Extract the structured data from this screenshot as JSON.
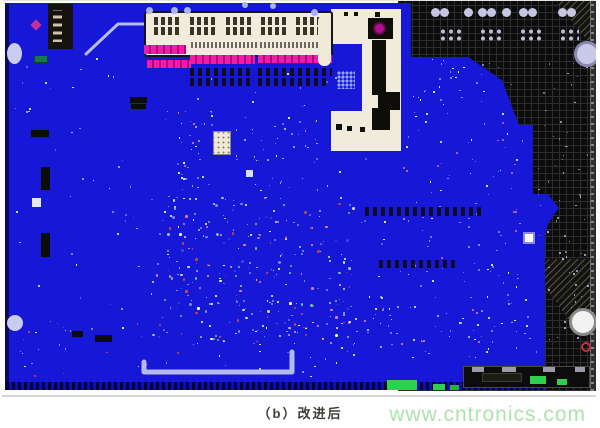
{
  "caption": {
    "text": "（b）改进后"
  },
  "watermark": {
    "text": "www.cntronics.com"
  },
  "board": {
    "palette": {
      "board_blue": "#1717d8",
      "magenta": "#e312a0",
      "grid_black": "#0c0c0c",
      "grid_line": "#2d2d2d",
      "cream": "#f0ebdb",
      "lavender": "#c9cdf0",
      "green": "#2fcf4f",
      "trace": "#b4baea",
      "watermark_green": "#aee2ae",
      "caption_text": "#3e3e36",
      "red": "#c23040"
    },
    "connector": {
      "x": 142,
      "y": 10,
      "w": 189,
      "h": 46,
      "row1_y": 4,
      "row2_y": 14,
      "pad_group_xs": [
        8,
        44,
        80,
        115,
        150
      ],
      "pad_group_w": 27,
      "pad_group_h": 8,
      "strips": [
        {
          "x": 45,
          "y": 29,
          "w": 66,
          "h": 6
        },
        {
          "x": 114,
          "y": 29,
          "w": 66,
          "h": 6
        }
      ]
    },
    "traces": {
      "paths": [
        {
          "name": "trace-top-left",
          "width": 3,
          "points": [
            [
              84,
              53
            ],
            [
              116,
              23
            ],
            [
              143,
              23
            ]
          ]
        },
        {
          "name": "trace-bottom-u",
          "width": 5,
          "points": [
            [
              142,
              361
            ],
            [
              142,
              371
            ],
            [
              290,
              371
            ],
            [
              290,
              351
            ]
          ]
        }
      ]
    },
    "components": [
      {
        "name": "ic-top-left",
        "type": "ic",
        "x": 46,
        "y": 3,
        "w": 25,
        "h": 45
      },
      {
        "name": "magenta-diamond",
        "type": "rect",
        "x": 30,
        "y": 20,
        "w": 8,
        "h": 8,
        "color": "#c23099",
        "rot": 45
      },
      {
        "name": "green-chip-left",
        "type": "rect",
        "x": 32,
        "y": 54,
        "w": 14,
        "h": 8,
        "color": "#157a46",
        "border": "1px solid #0a4428"
      },
      {
        "name": "mounting-hole-left-top",
        "type": "circle",
        "x": 5,
        "y": 42,
        "w": 15,
        "h": 21,
        "color": "#c9cdf0"
      },
      {
        "name": "mounting-hole-left-bottom",
        "type": "circle",
        "x": 5,
        "y": 314,
        "w": 16,
        "h": 16,
        "color": "#c9cdf0"
      },
      {
        "name": "bar-dark-1",
        "type": "rect",
        "x": 128,
        "y": 96,
        "w": 17,
        "h": 6,
        "color": "#0d0d08"
      },
      {
        "name": "bar-dark-2",
        "type": "rect",
        "x": 129,
        "y": 103,
        "w": 15,
        "h": 5,
        "color": "#0d0d08"
      },
      {
        "name": "bar-dark-3",
        "type": "rect",
        "x": 29,
        "y": 129,
        "w": 18,
        "h": 7,
        "color": "#0d0d08"
      },
      {
        "name": "bar-dark-4",
        "type": "rect",
        "x": 39,
        "y": 166,
        "w": 9,
        "h": 23,
        "color": "#0d0d08"
      },
      {
        "name": "bar-dark-5",
        "type": "rect",
        "x": 39,
        "y": 232,
        "w": 9,
        "h": 24,
        "color": "#0d0d08"
      },
      {
        "name": "bar-dark-6",
        "type": "rect",
        "x": 93,
        "y": 334,
        "w": 17,
        "h": 7,
        "color": "#0d0d08"
      },
      {
        "name": "bar-dark-7",
        "type": "rect",
        "x": 70,
        "y": 330,
        "w": 11,
        "h": 6,
        "color": "#0d0d08"
      },
      {
        "name": "pad-white-1",
        "type": "rect",
        "x": 30,
        "y": 197,
        "w": 9,
        "h": 9,
        "color": "#e4e8fa"
      },
      {
        "name": "pad-white-2",
        "type": "rect",
        "x": 244,
        "y": 169,
        "w": 7,
        "h": 7,
        "color": "#d8defa"
      },
      {
        "name": "chip-center",
        "type": "chip",
        "x": 211,
        "y": 130,
        "w": 18,
        "h": 24
      },
      {
        "name": "pad-white-ringed",
        "type": "rect",
        "x": 521,
        "y": 231,
        "w": 12,
        "h": 12,
        "color": "#ffffff",
        "border": "2px solid #8a8af0"
      },
      {
        "name": "circle-top-right",
        "type": "circle",
        "x": 572,
        "y": 40,
        "w": 26,
        "h": 26,
        "color": "#c9c9e8",
        "border": "3px solid #8a8ab0"
      },
      {
        "name": "circle-bottom-right",
        "type": "circle",
        "x": 567,
        "y": 307,
        "w": 28,
        "h": 28,
        "color": "#f2f2f2",
        "border": "3px solid #8a8a8a"
      },
      {
        "name": "ring-red",
        "type": "circle",
        "x": 579,
        "y": 341,
        "w": 10,
        "h": 10,
        "color": "rgba(0,0,0,0)",
        "border": "2px solid #c23040"
      },
      {
        "name": "via-1",
        "type": "circle",
        "x": 144,
        "y": 6,
        "w": 7,
        "h": 7,
        "color": "#a9b3f2"
      },
      {
        "name": "via-2",
        "type": "circle",
        "x": 169,
        "y": 6,
        "w": 7,
        "h": 7,
        "color": "#a9b3f2"
      },
      {
        "name": "via-3",
        "type": "circle",
        "x": 182,
        "y": 6,
        "w": 7,
        "h": 7,
        "color": "#a9b3f2"
      },
      {
        "name": "via-4",
        "type": "circle",
        "x": 309,
        "y": 8,
        "w": 7,
        "h": 7,
        "color": "#a9b3f2"
      },
      {
        "name": "via-5",
        "type": "circle",
        "x": 240,
        "y": 1,
        "w": 6,
        "h": 6,
        "color": "#a9b3f2"
      },
      {
        "name": "via-6",
        "type": "circle",
        "x": 268,
        "y": 2,
        "w": 6,
        "h": 6,
        "color": "#a9b3f2"
      },
      {
        "name": "grid-pad-1",
        "type": "circle",
        "x": 429,
        "y": 7,
        "w": 9,
        "h": 9,
        "color": "#c6c6e2"
      },
      {
        "name": "grid-pad-2",
        "type": "circle",
        "x": 438,
        "y": 7,
        "w": 9,
        "h": 9,
        "color": "#c6c6e2"
      },
      {
        "name": "grid-pad-3",
        "type": "circle",
        "x": 462,
        "y": 7,
        "w": 9,
        "h": 9,
        "color": "#c6c6e2"
      },
      {
        "name": "grid-pad-4",
        "type": "circle",
        "x": 476,
        "y": 7,
        "w": 9,
        "h": 9,
        "color": "#c6c6e2"
      },
      {
        "name": "grid-pad-5",
        "type": "circle",
        "x": 485,
        "y": 7,
        "w": 9,
        "h": 9,
        "color": "#c6c6e2"
      },
      {
        "name": "grid-pad-6",
        "type": "circle",
        "x": 500,
        "y": 7,
        "w": 9,
        "h": 9,
        "color": "#c6c6e2"
      },
      {
        "name": "grid-pad-7",
        "type": "circle",
        "x": 517,
        "y": 7,
        "w": 9,
        "h": 9,
        "color": "#c6c6e2"
      },
      {
        "name": "grid-pad-8",
        "type": "circle",
        "x": 526,
        "y": 7,
        "w": 9,
        "h": 9,
        "color": "#c6c6e2"
      },
      {
        "name": "grid-pad-9",
        "type": "circle",
        "x": 556,
        "y": 7,
        "w": 9,
        "h": 9,
        "color": "#c6c6e2"
      },
      {
        "name": "grid-pad-10",
        "type": "circle",
        "x": 565,
        "y": 7,
        "w": 9,
        "h": 9,
        "color": "#c6c6e2"
      },
      {
        "name": "pad-grid-1",
        "type": "padgrid",
        "x": 437,
        "y": 27,
        "w": 23,
        "h": 14
      },
      {
        "name": "pad-grid-2",
        "type": "padgrid",
        "x": 477,
        "y": 27,
        "w": 23,
        "h": 14
      },
      {
        "name": "pad-grid-3",
        "type": "padgrid",
        "x": 517,
        "y": 27,
        "w": 23,
        "h": 14
      },
      {
        "name": "pad-grid-4",
        "type": "padgrid",
        "x": 557,
        "y": 27,
        "w": 20,
        "h": 14
      },
      {
        "name": "pink-pads-a",
        "type": "padrow-magenta",
        "x": 142,
        "y": 44,
        "w": 42,
        "h": 9
      },
      {
        "name": "pink-pads-b",
        "type": "padrow-magenta",
        "x": 145,
        "y": 59,
        "w": 44,
        "h": 8
      },
      {
        "name": "pink-pads-c",
        "type": "padrow-magenta",
        "x": 188,
        "y": 54,
        "w": 65,
        "h": 9
      },
      {
        "name": "pink-pads-d",
        "type": "padrow-magenta",
        "x": 256,
        "y": 54,
        "w": 74,
        "h": 8
      },
      {
        "name": "pad-row-1",
        "type": "padrow-dark",
        "x": 188,
        "y": 67,
        "w": 64,
        "h": 8
      },
      {
        "name": "pad-row-2",
        "type": "padrow-dark",
        "x": 188,
        "y": 77,
        "w": 64,
        "h": 8
      },
      {
        "name": "pad-row-3",
        "type": "padrow-dark",
        "x": 256,
        "y": 67,
        "w": 74,
        "h": 8
      },
      {
        "name": "pad-row-4",
        "type": "padrow-dark",
        "x": 256,
        "y": 77,
        "w": 68,
        "h": 8
      },
      {
        "name": "pad-row-mid",
        "type": "padrow-dark",
        "x": 363,
        "y": 206,
        "w": 118,
        "h": 9
      },
      {
        "name": "pad-row-mid-2",
        "type": "padrow-dark",
        "x": 377,
        "y": 259,
        "w": 78,
        "h": 8
      },
      {
        "name": "dot-matrix",
        "type": "dotgrid",
        "x": 335,
        "y": 70,
        "w": 18,
        "h": 18
      },
      {
        "name": "cutout-mini-board",
        "type": "rect",
        "x": 316,
        "y": 14,
        "w": 13,
        "h": 51,
        "color": "#efe9da",
        "radius": 6
      },
      {
        "name": "cutout-ic-1",
        "type": "rect",
        "x": 366,
        "y": 17,
        "w": 25,
        "h": 21,
        "color": "#0f0d0a"
      },
      {
        "name": "cutout-ic-2",
        "type": "rect",
        "x": 370,
        "y": 39,
        "w": 14,
        "h": 55,
        "color": "#0f0d0a"
      },
      {
        "name": "cutout-ic-3",
        "type": "rect",
        "x": 376,
        "y": 91,
        "w": 22,
        "h": 18,
        "color": "#0f0d0a"
      },
      {
        "name": "cutout-ic-4",
        "type": "rect",
        "x": 370,
        "y": 107,
        "w": 18,
        "h": 22,
        "color": "#0f0d0a"
      },
      {
        "name": "cutout-led-magenta",
        "type": "circle",
        "x": 371,
        "y": 21,
        "w": 13,
        "h": 13,
        "color": "#b01090",
        "border": "2px solid #5c0a48"
      },
      {
        "name": "cutout-dot-1",
        "type": "rect",
        "x": 334,
        "y": 123,
        "w": 6,
        "h": 6,
        "color": "#101010"
      },
      {
        "name": "cutout-dot-2",
        "type": "rect",
        "x": 345,
        "y": 125,
        "w": 5,
        "h": 5,
        "color": "#101010"
      },
      {
        "name": "cutout-dot-3",
        "type": "rect",
        "x": 358,
        "y": 126,
        "w": 5,
        "h": 5,
        "color": "#141414"
      },
      {
        "name": "cutout-dot-4",
        "type": "rect",
        "x": 342,
        "y": 11,
        "w": 4,
        "h": 4,
        "color": "#101010"
      },
      {
        "name": "cutout-dot-5",
        "type": "rect",
        "x": 352,
        "y": 11,
        "w": 4,
        "h": 4,
        "color": "#101010"
      },
      {
        "name": "cutout-dot-6",
        "type": "rect",
        "x": 373,
        "y": 11,
        "w": 5,
        "h": 5,
        "color": "#101010"
      },
      {
        "name": "bottom-connector-bar",
        "type": "rect",
        "x": 461,
        "y": 365,
        "w": 127,
        "h": 22,
        "color": "#0c0c0c",
        "border": "1px solid #4a4a42"
      },
      {
        "name": "bar-pad-1",
        "type": "rect",
        "x": 470,
        "y": 366,
        "w": 12,
        "h": 5,
        "color": "#9a9aa8"
      },
      {
        "name": "bar-pad-2",
        "type": "rect",
        "x": 500,
        "y": 366,
        "w": 14,
        "h": 5,
        "color": "#9a9aa8"
      },
      {
        "name": "bar-pad-3",
        "type": "rect",
        "x": 541,
        "y": 366,
        "w": 12,
        "h": 5,
        "color": "#9a9aa8"
      },
      {
        "name": "bar-pad-4",
        "type": "rect",
        "x": 573,
        "y": 366,
        "w": 10,
        "h": 5,
        "color": "#9a9aa8"
      },
      {
        "name": "bar-dark-inner",
        "type": "rect",
        "x": 480,
        "y": 372,
        "w": 40,
        "h": 9,
        "color": "#1c1c14",
        "border": "1px solid #3c3c30"
      },
      {
        "name": "bar-green-1",
        "type": "rect",
        "x": 528,
        "y": 375,
        "w": 16,
        "h": 8,
        "color": "#2fcf4f"
      },
      {
        "name": "bar-green-2",
        "type": "rect",
        "x": 555,
        "y": 378,
        "w": 10,
        "h": 6,
        "color": "#2fcf4f"
      },
      {
        "name": "green-pad-1",
        "type": "rect",
        "x": 385,
        "y": 379,
        "w": 30,
        "h": 10,
        "color": "#2fcf4f"
      },
      {
        "name": "green-pad-2",
        "type": "rect",
        "x": 431,
        "y": 383,
        "w": 12,
        "h": 6,
        "color": "#2fcf4f"
      },
      {
        "name": "green-pad-3",
        "type": "rect",
        "x": 448,
        "y": 384,
        "w": 9,
        "h": 5,
        "color": "#28b043"
      }
    ],
    "texture": {
      "seed": 7,
      "clusters": [
        {
          "name": "board-sparse",
          "area": [
            12,
            55,
            380,
            300
          ],
          "n": 150,
          "smin": 1,
          "smax": 2,
          "colors": [
            "#8d9bf0",
            "#ffffff",
            "#b8c4ff",
            "#6070e8"
          ]
        },
        {
          "name": "center-dense",
          "area": [
            150,
            195,
            200,
            145
          ],
          "n": 240,
          "smin": 1,
          "smax": 3,
          "colors": [
            "#a8b4ff",
            "#ffffff",
            "#e07fc0",
            "#c04848",
            "#68c888",
            "#7888ff",
            "#3845e8",
            "#d8d8ff"
          ]
        },
        {
          "name": "upper-mid",
          "area": [
            175,
            105,
            140,
            85
          ],
          "n": 70,
          "smin": 1,
          "smax": 2,
          "colors": [
            "#a8b4ff",
            "#ffffff",
            "#d880c0",
            "#7888ff"
          ]
        },
        {
          "name": "right-blue",
          "area": [
            395,
            120,
            125,
            180
          ],
          "n": 90,
          "smin": 1,
          "smax": 2,
          "colors": [
            "#94a2f4",
            "#ffffff",
            "#c870b0",
            "#8090e8"
          ]
        },
        {
          "name": "right-blue-top",
          "area": [
            408,
            58,
            105,
            58
          ],
          "n": 35,
          "smin": 1,
          "smax": 2,
          "colors": [
            "#94a2f4",
            "#ffffff"
          ]
        },
        {
          "name": "grid-mid-dots",
          "area": [
            535,
            55,
            50,
            210
          ],
          "n": 40,
          "smin": 1,
          "smax": 2,
          "colors": [
            "#b6b6d6",
            "#8888aa"
          ]
        },
        {
          "name": "grid-low-dots",
          "area": [
            545,
            230,
            42,
            120
          ],
          "n": 25,
          "smin": 1,
          "smax": 2,
          "colors": [
            "#b6b6d6"
          ]
        },
        {
          "name": "bottom-mid",
          "area": [
            340,
            295,
            195,
            62
          ],
          "n": 70,
          "smin": 1,
          "smax": 2,
          "colors": [
            "#a8b4ff",
            "#ffffff",
            "#8090e8",
            "#e07fc0"
          ]
        },
        {
          "name": "bottom-left",
          "area": [
            15,
            320,
            360,
            55
          ],
          "n": 55,
          "smin": 1,
          "smax": 2,
          "colors": [
            "#97a4f2",
            "#ffffff",
            "#c04848"
          ]
        }
      ]
    }
  }
}
